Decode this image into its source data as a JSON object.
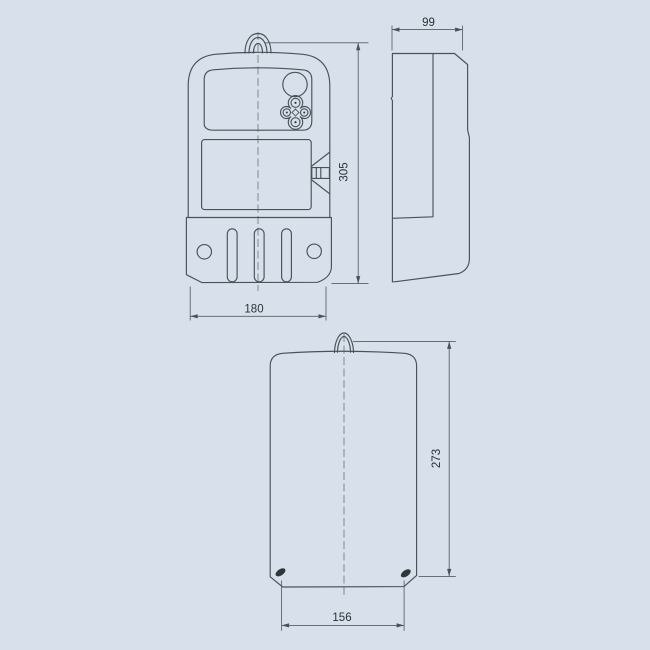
{
  "colors": {
    "background": "#d8e1eb",
    "line": "#4b5157",
    "dimension_line": "#575d63",
    "text": "#2b3036"
  },
  "dimensions": {
    "front": {
      "width": "180",
      "height": "305"
    },
    "side": {
      "width": "99"
    },
    "back": {
      "width": "156",
      "height": "273"
    }
  }
}
